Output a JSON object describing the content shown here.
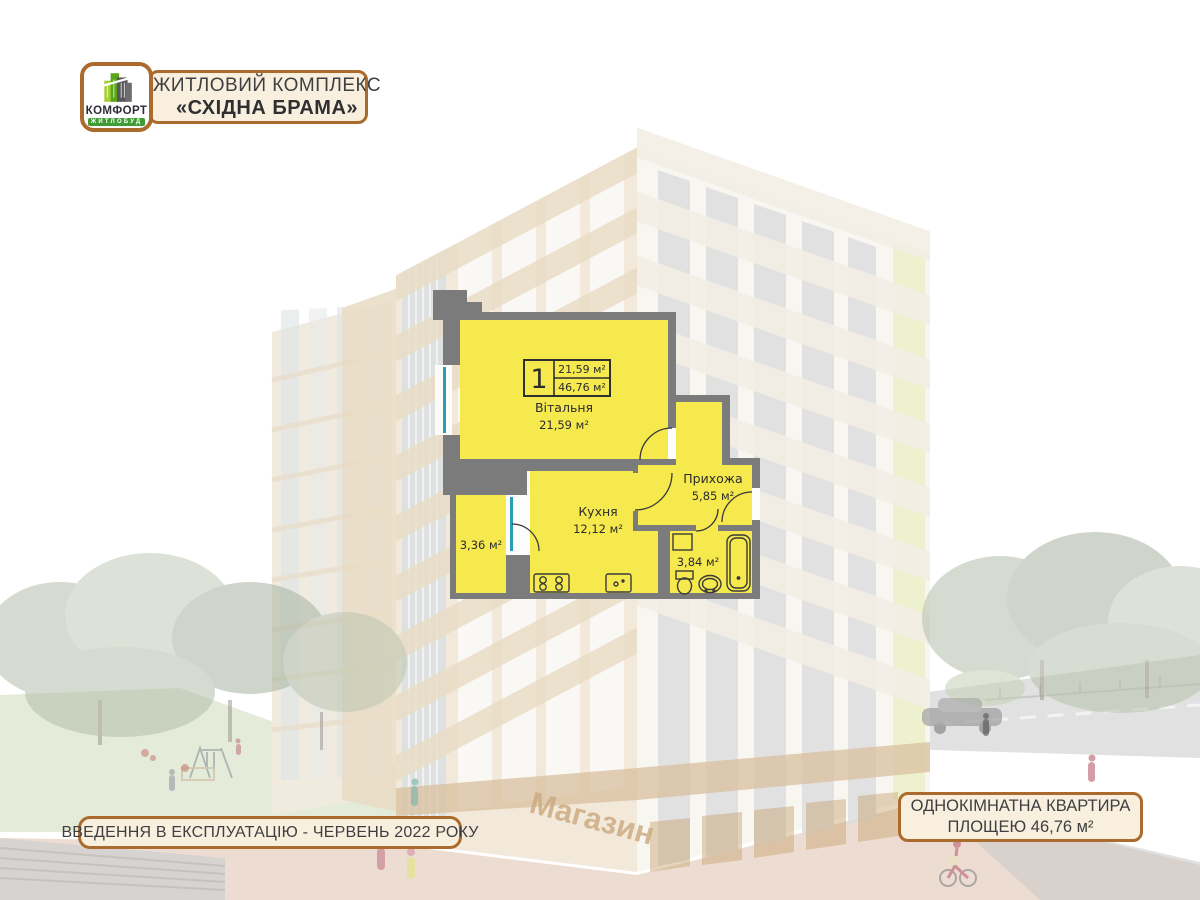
{
  "header": {
    "logo": {
      "brand": "КОМФОРТ",
      "sub": "ЖИТЛОБУД"
    },
    "title_line1": "ЖИТЛОВИЙ КОМПЛЕКС",
    "title_line2": "«СХІДНА БРАМА»"
  },
  "plan": {
    "info": {
      "rooms_count": "1",
      "room_area": "21,59 м²",
      "total_area": "46,76 м²"
    },
    "rooms": {
      "living": {
        "name": "Вітальня",
        "area": "21,59 м²"
      },
      "kitchen": {
        "name": "Кухня",
        "area": "12,12 м²"
      },
      "hall": {
        "name": "Прихожа",
        "area": "5,85 м²"
      },
      "balcony": {
        "area": "3,36 м²"
      },
      "bathroom": {
        "area": "3,84 м²"
      }
    }
  },
  "background": {
    "store_sign": "Магазин"
  },
  "footer": {
    "left": "ВВЕДЕННЯ В ЕКСПЛУАТАЦІЮ - ЧЕРВЕНЬ 2022 РОКУ",
    "right_line1": "ОДНОКІМНАТНА КВАРТИРА",
    "right_line2": "ПЛОЩЕЮ 46,76 м²"
  },
  "colors": {
    "accent_border": "#aa6b2d",
    "plan_yellow": "#f5e94e",
    "wall_gray": "#7b7b7b",
    "glass_teal": "#2a9cb4",
    "logo_green": "#3f9c35"
  }
}
